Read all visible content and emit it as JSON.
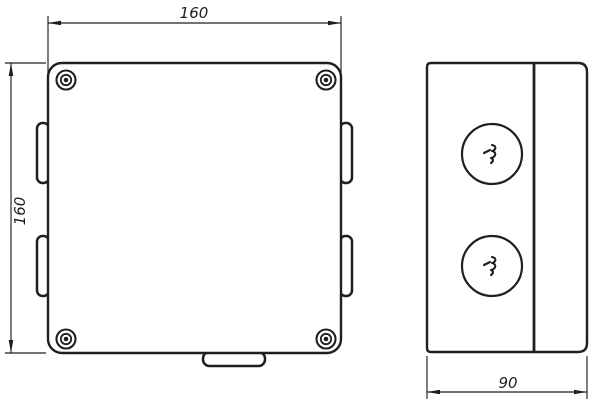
{
  "drawing": {
    "dimensions": {
      "front_width": "160",
      "front_height": "160",
      "side_depth": "90"
    },
    "colors": {
      "line": "#1f1f1f",
      "background": "#ffffff"
    }
  }
}
